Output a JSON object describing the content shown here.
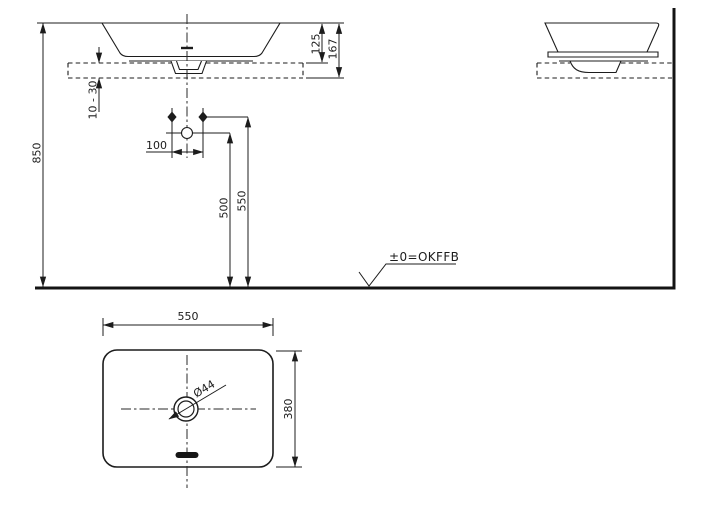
{
  "front_view": {
    "dim_height_floor_to_rim": "850",
    "dim_rim_to_counter_top": "125",
    "dim_rim_to_counter_bottom": "167",
    "dim_counter_thickness": "10 - 30",
    "dim_fixing_hole_spacing": "100",
    "dim_drain_outlet_height": "500",
    "dim_fixing_holes_height": "550"
  },
  "floor": {
    "level_label": "±0=OKFFB"
  },
  "top_view": {
    "dim_width": "550",
    "dim_depth": "380",
    "dim_drain_diameter": "Ø44"
  }
}
